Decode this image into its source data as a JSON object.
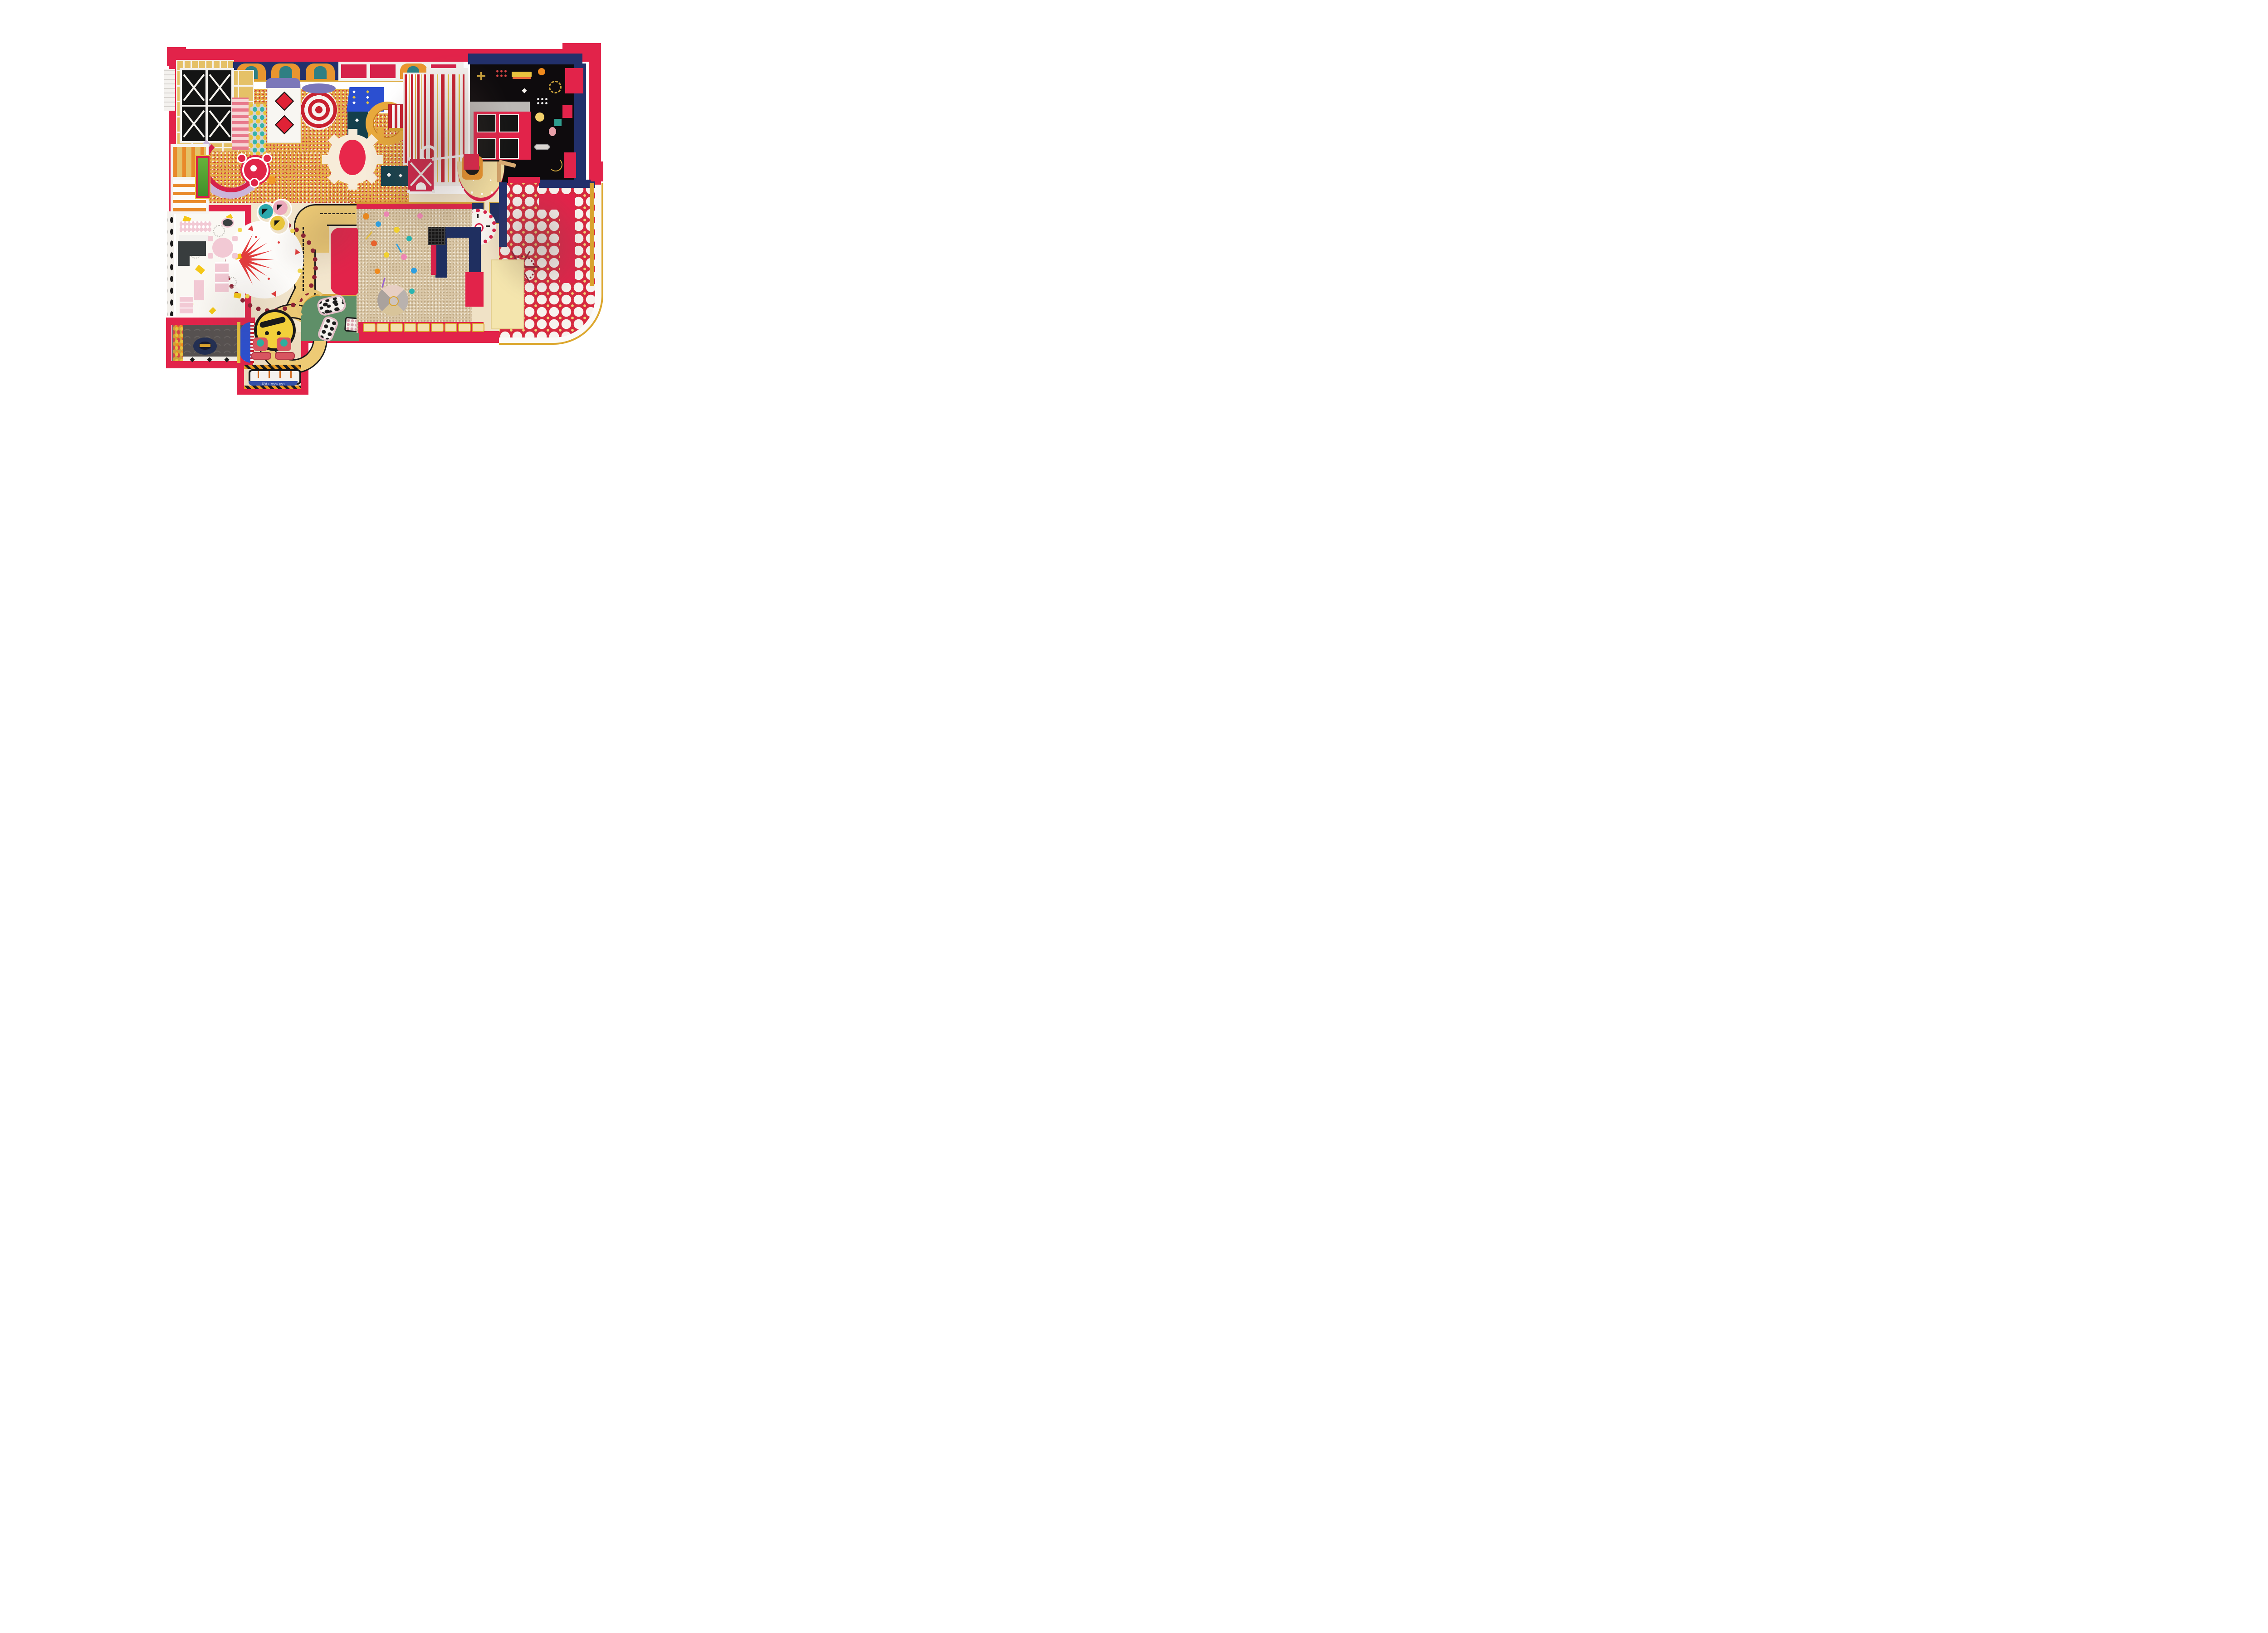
{
  "meta": {
    "title": "Indoor children's playground — top-down 3D floor-plan render",
    "style": "circus / carnival theme, red-gold-navy palette",
    "view": "orthographic top view, white background"
  },
  "labels": {
    "tool_room_mat": "Tool room 工具房"
  },
  "palette": {
    "wall_red": "#e2234a",
    "deep_red": "#c8202f",
    "maroon_decal": "#8e2033",
    "navy": "#22306b",
    "royal_blue": "#2b4fd0",
    "gold_trim": "#d9a32e",
    "panel_gold": "#e5c167",
    "road_yellow": "#edca75",
    "cream_floor": "#f3e6cd",
    "bean_pit_tan": "#d9c6a6",
    "dotted_floor_red": "#d6293f",
    "green_mat": "#5f8f68",
    "lavender_slide": "#cbb5d9",
    "teal_walkway": "#133f4c",
    "pink_furniture": "#f2c9d4",
    "arcade_black": "#0e0b0d",
    "white": "#fbfaf8"
  },
  "zones": [
    {
      "name": "softplay-structure",
      "desc": "white steel-frame soft play maze with gold panels, 4 black trampolines with white X braces, lavender curved tube slide, orange climbing peg modules"
    },
    {
      "name": "ball-pit",
      "desc": "large pit of red, white and gold balls with cream gear-shaped platform, striped circus-cone slide tower, diamond-banner slide, blue box slide, gold spiral tube slide, target spinner toy"
    },
    {
      "name": "arcade-room",
      "desc": "top-right room, black floor with playful carnival doodles, navy border walls, red kiosk with four black interactive screens, gray corridor"
    },
    {
      "name": "wave-slide",
      "desc": "red/white/gold striped wave slide with white spiral squiggle"
    },
    {
      "name": "party-room",
      "desc": "beige floor, red wall with two black TVs, semicircle stage mat with red dotted rim, drum photo-op, navy benches, scalloped clock decal, wooden door"
    },
    {
      "name": "dotted-floor-lounge",
      "desc": "red floor with white polka circles and gold diamonds, maroon ferris-wheel decal, red L-shaped couch, cream table, white rounded corner walkway with gold edge"
    },
    {
      "name": "toddler-road",
      "desc": "yellow toy road with black dashed centerline, corner, straight and roundabout loop"
    },
    {
      "name": "carousel-top",
      "desc": "white disc with red starburst rays, yellow and red dots, maroon scalloped ring"
    },
    {
      "name": "ride-on-balls",
      "desc": "teal, pink and yellow sit-on balls with faces parked in cream alcoves"
    },
    {
      "name": "cow-corral",
      "desc": "green mat with cow-print rocker toys and cow table"
    },
    {
      "name": "bean-pit",
      "desc": "tan cassia-seed sensory pit with buckets, shovels, climbing dome, navy tower and red blocks"
    },
    {
      "name": "bench-wall",
      "desc": "red south wall with row of gold-trimmed seat slots"
    },
    {
      "name": "dressup-room",
      "desc": "white floor with yellow confetti, pink clothing racks, oval table with stools, shelf, dresser, mirror, dark counter"
    },
    {
      "name": "market-room",
      "desc": "play supermarket: gold food shelves, navy oval checkout counter, arch-pattern dark floor, blue half-pipe, black-and-white tiled strip"
    },
    {
      "name": "tool-room",
      "desc": "bottom annex with two red kiddie ride cars, yellow smiley decal, hazard stripes and tool mat"
    },
    {
      "name": "striped-tent-awning",
      "desc": "red and white striped vendor awning booth"
    },
    {
      "name": "x-top-tent",
      "desc": "small red tent with white X roof ribs and dome window"
    },
    {
      "name": "cabinet-row",
      "desc": "top wall row of ornate navy/orange carnival cabinets and red framed stalls"
    }
  ],
  "objects": {
    "trampoline_cells": 4,
    "kiosk_screens": 4,
    "party_room_tvs": 2,
    "kiddie_cars": 2,
    "ride_on_balls": 3,
    "cow_toys": 3,
    "navy_benches": 2,
    "bench_slots": 9,
    "red_diamonds_on_banner": 2,
    "alcove_rings": 3
  }
}
